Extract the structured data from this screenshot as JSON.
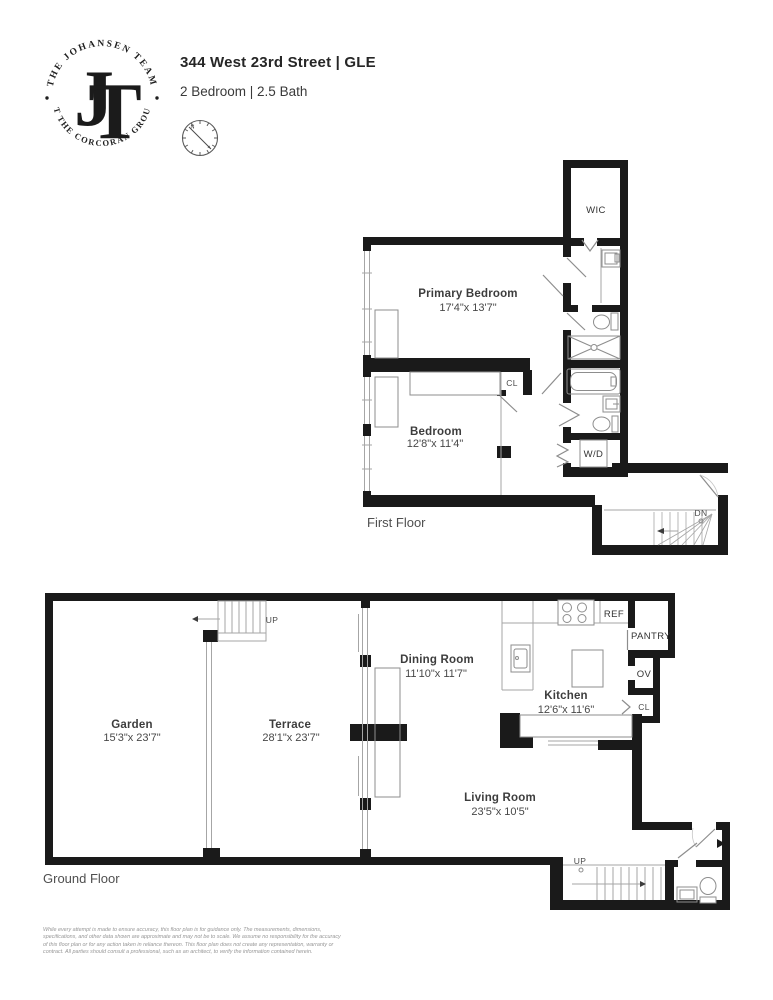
{
  "header": {
    "logo": {
      "arc_top": "THE JOHANSEN TEAM",
      "arc_bottom": "AT THE CORCORAN GROUP",
      "monogram_j": "J",
      "monogram_t": "T"
    },
    "title": "344 West 23rd Street | GLE",
    "subtitle": "2 Bedroom | 2.5 Bath",
    "compass": {
      "north_label": "N"
    }
  },
  "first_floor": {
    "floor_label": "First Floor",
    "rooms": {
      "primary_bedroom": {
        "name": "Primary Bedroom",
        "dims": "17'4\"x 13'7\""
      },
      "bedroom": {
        "name": "Bedroom",
        "dims": "12'8\"x 11'4\""
      }
    },
    "labels": {
      "wic": "WIC",
      "closet": "CL",
      "washer_dryer": "W/D",
      "stairs_down": "DN"
    }
  },
  "ground_floor": {
    "floor_label": "Ground Floor",
    "rooms": {
      "garden": {
        "name": "Garden",
        "dims": "15'3\"x 23'7\""
      },
      "terrace": {
        "name": "Terrace",
        "dims": "28'1\"x 23'7\""
      },
      "dining_room": {
        "name": "Dining Room",
        "dims": "11'10\"x 11'7\""
      },
      "kitchen": {
        "name": "Kitchen",
        "dims": "12'6\"x 11'6\""
      },
      "living_room": {
        "name": "Living Room",
        "dims": "23'5\"x 10'5\""
      }
    },
    "labels": {
      "refrigerator": "REF",
      "pantry": "PANTRY",
      "oven": "OV",
      "closet": "CL",
      "stairs_up_garden": "UP",
      "stairs_up_living": "UP"
    }
  },
  "disclaimer": {
    "lines": [
      "While every attempt is made to ensure accuracy, this floor plan is for guidance only. The measurements, dimensions,",
      "specifications, and other data shown are approximate and may not be to scale. We assume no responsibility for the accuracy",
      "of this floor plan or for any action taken in reliance thereon. This floor plan does not create any representation, warranty or",
      "contract. All parties should consult a professional, such as an architect, to verify the information contained herein."
    ]
  },
  "colors": {
    "wall": "#1a1a1a",
    "thin_line": "#a6a6a6",
    "fixture_line": "#8d8d8d",
    "label_text": "#3d3d3d"
  }
}
